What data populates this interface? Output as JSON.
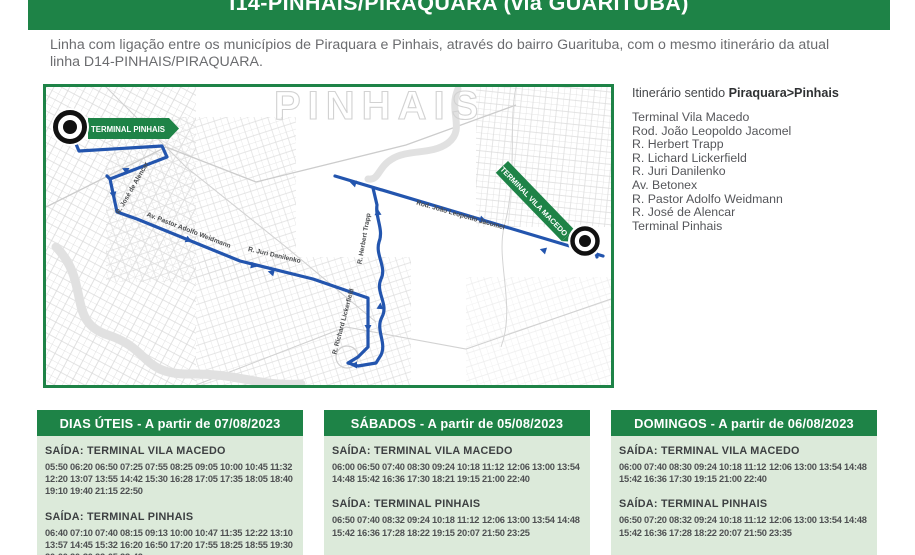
{
  "header": {
    "title": "I14-PINHAIS/PIRAQUARA (via GUARITUBA)"
  },
  "description": "Linha com ligação entre os municípios de Piraquara e Pinhais, através do bairro Guarituba, com o mesmo itinerário da atual linha D14-PINHAIS/PIRAQUARA.",
  "map": {
    "watermark": "PINHAIS",
    "terminal_pinhais_label": "TERMINAL PINHAIS",
    "terminal_vila_macedo_label": "TERMINAL VILA MACEDO",
    "street_labels": [
      "R. José de Alencar",
      "Av. Pastor Adolfo Weidmann",
      "R. Juri Danilenko",
      "R. Herbert Trapp",
      "R. Richard Lickerfield",
      "Rod. João Leopoldo Jacomel"
    ],
    "route_color": "#2355ae",
    "green": "#1e8347"
  },
  "itinerary": {
    "title_regular": "Itinerário sentido ",
    "title_bold": "Piraquara>Pinhais",
    "stops": [
      "Terminal Vila Macedo",
      "Rod. João Leopoldo Jacomel",
      "R. Herbert Trapp",
      "R. Lichard Lickerfield",
      "R. Juri Danilenko",
      "Av. Betonex",
      "R. Pastor Adolfo Weidmann",
      "R. José de Alencar",
      "Terminal Pinhais"
    ]
  },
  "schedules": [
    {
      "title": "DIAS ÚTEIS - A partir de 07/08/2023",
      "sections": [
        {
          "label": "SAÍDA: TERMINAL VILA MACEDO",
          "times": [
            "05:50",
            "06:20",
            "06:50",
            "07:25",
            "07:55",
            "08:25",
            "09:05",
            "10:00",
            "10:45",
            "11:32",
            "12:20",
            "13:07",
            "13:55",
            "14:42",
            "15:30",
            "16:28",
            "17:05",
            "17:35",
            "18:05",
            "18:40",
            "19:10",
            "19:40",
            "21:15",
            "22:50"
          ]
        },
        {
          "label": "SAÍDA: TERMINAL PINHAIS",
          "times": [
            "06:40",
            "07:10",
            "07:40",
            "08:15",
            "09:13",
            "10:00",
            "10:47",
            "11:35",
            "12:22",
            "13:10",
            "13:57",
            "14:45",
            "15:32",
            "16:20",
            "16:50",
            "17:20",
            "17:55",
            "18:25",
            "18:55",
            "19:30",
            "20:00",
            "20:30",
            "22:05",
            "23:42"
          ]
        }
      ]
    },
    {
      "title": "SÁBADOS - A partir de 05/08/2023",
      "sections": [
        {
          "label": "SAÍDA: TERMINAL VILA MACEDO",
          "times": [
            "06:00",
            "06:50",
            "07:40",
            "08:30",
            "09:24",
            "10:18",
            "11:12",
            "12:06",
            "13:00",
            "13:54",
            "14:48",
            "15:42",
            "16:36",
            "17:30",
            "18:21",
            "19:15",
            "21:00",
            "22:40"
          ]
        },
        {
          "label": "SAÍDA: TERMINAL PINHAIS",
          "times": [
            "06:50",
            "07:40",
            "08:32",
            "09:24",
            "10:18",
            "11:12",
            "12:06",
            "13:00",
            "13:54",
            "14:48",
            "15:42",
            "16:36",
            "17:28",
            "18:22",
            "19:15",
            "20:07",
            "21:50",
            "23:25"
          ]
        }
      ]
    },
    {
      "title": "DOMINGOS - A partir de 06/08/2023",
      "sections": [
        {
          "label": "SAÍDA: TERMINAL VILA MACEDO",
          "times": [
            "06:00",
            "07:40",
            "08:30",
            "09:24",
            "10:18",
            "11:12",
            "12:06",
            "13:00",
            "13:54",
            "14:48",
            "15:42",
            "16:36",
            "17:30",
            "19:15",
            "21:00",
            "22:40"
          ]
        },
        {
          "label": "SAÍDA: TERMINAL PINHAIS",
          "times": [
            "06:50",
            "07:20",
            "08:32",
            "09:24",
            "10:18",
            "11:12",
            "12:06",
            "13:00",
            "13:54",
            "14:48",
            "15:42",
            "16:36",
            "17:28",
            "18:22",
            "20:07",
            "21:50",
            "23:35"
          ]
        }
      ]
    }
  ],
  "colors": {
    "green": "#1e8347",
    "light_green": "#dceada",
    "route_blue": "#2355ae"
  }
}
